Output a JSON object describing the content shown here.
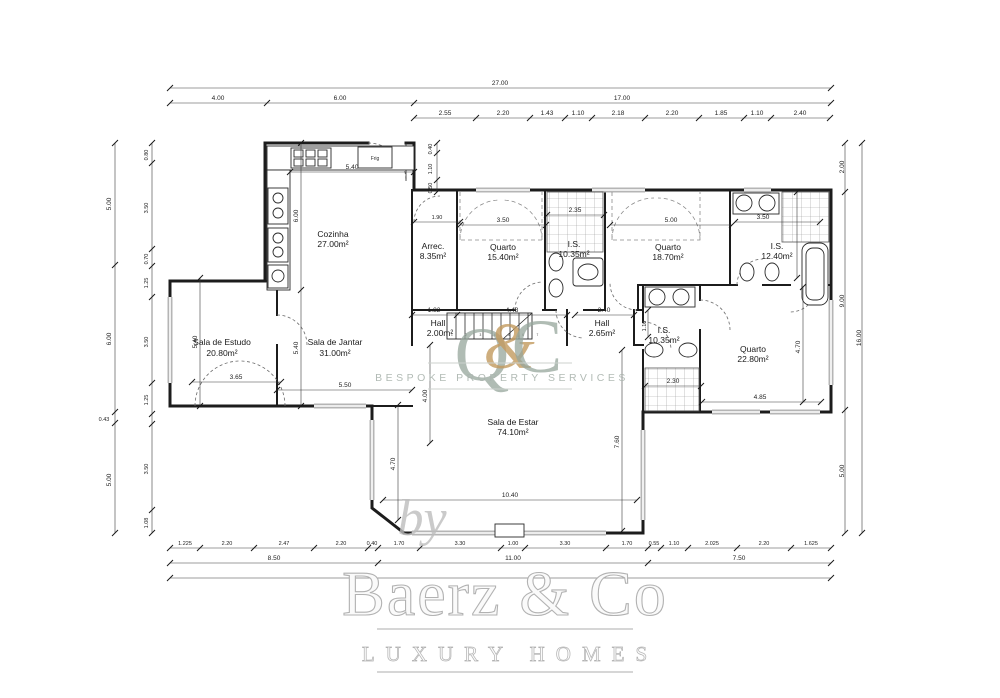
{
  "watermarks": {
    "logo_q": "Q",
    "logo_amp": "&",
    "logo_c": "C",
    "logo_tagline": "BESPOKE PROPERTY SERVICES",
    "by": "by",
    "brand": "Baerz & Co",
    "brand_tagline": "LUXURY HOMES"
  },
  "colors": {
    "wall": "#1c1c1c",
    "dimension": "#3a3a3a",
    "window": "#b5b5b5",
    "logo_green": "#96a69c",
    "logo_gold": "#c39a5e",
    "brand_gray": "#b2b2b2"
  },
  "rooms": [
    {
      "name": "Cozinha",
      "area": "27.00m²"
    },
    {
      "name": "Arrec.",
      "area": "8.35m²"
    },
    {
      "name": "Quarto",
      "area": "15.40m²"
    },
    {
      "name": "I.S.",
      "area": "10.35m²"
    },
    {
      "name": "Quarto",
      "area": "18.70m²"
    },
    {
      "name": "I.S.",
      "area": "12.40m²"
    },
    {
      "name": "Sala de Estudo",
      "area": "20.80m²"
    },
    {
      "name": "Sala de Jantar",
      "area": "31.00m²"
    },
    {
      "name": "Hall",
      "area": "2.00m²"
    },
    {
      "name": "Hall",
      "area": "2.65m²"
    },
    {
      "name": "I.S.",
      "area": "10.35m²"
    },
    {
      "name": "Quarto",
      "area": "22.80m²"
    },
    {
      "name": "Sala de Estar",
      "area": "74.10m²"
    }
  ],
  "fixtures": {
    "fridge_label": "Frig",
    "stairs_numbers": "1 2 3 4 5 6 7"
  },
  "dims": {
    "top_total": "27.00",
    "top_mid": [
      "4.00",
      "6.00",
      "17.00"
    ],
    "top_detail": [
      "2.55",
      "2.20",
      "1.43",
      "1.10",
      "2.18",
      "2.20",
      "1.85",
      "1.10",
      "2.40"
    ],
    "bottom_detail": [
      "1.225",
      "2.20",
      "2.47",
      "2.20",
      "0.40",
      "1.70",
      "3.30",
      "1.00",
      "3.30",
      "1.70",
      "0.55",
      "1.10",
      "2.025",
      "2.20",
      "1.625"
    ],
    "bottom_mid": [
      "8.50",
      "11.00",
      "7.50"
    ],
    "left_outer": [
      "5.00",
      "6.00",
      "0.43",
      "5.00"
    ],
    "left_inner": [
      "0.80",
      "3.50",
      "0.70",
      "1.25",
      "3.50",
      "1.25",
      "3.50",
      "1.08"
    ],
    "right_inner": [
      "2.00",
      "9.00",
      "5.00"
    ],
    "right_total": "16.00",
    "kitchen_notch": [
      "0.40",
      "1.10",
      "0.50"
    ],
    "interior": {
      "kitchen_w": "5.40",
      "kitchen_h": "6.00",
      "jantar_h": "5.40",
      "estudo_h": "5.40",
      "arrec_w": "1.90",
      "quarto1_w": "3.50",
      "is1_w": "2.35",
      "quarto2_w": "5.00",
      "is2_w": "3.50",
      "estudo_door": "3.65",
      "jantar_w": "5.50",
      "hall1_w": "1.82",
      "stairs_w": "4.48",
      "hall2_w": "2.40",
      "hall2_h": "1.10",
      "estar_nw": "4.00",
      "is3_w": "2.30",
      "quarto3_h": "4.70",
      "quarto3_w": "4.85",
      "estar_wl": "4.70",
      "estar_er": "7.60",
      "estar_w": "10.40"
    }
  }
}
